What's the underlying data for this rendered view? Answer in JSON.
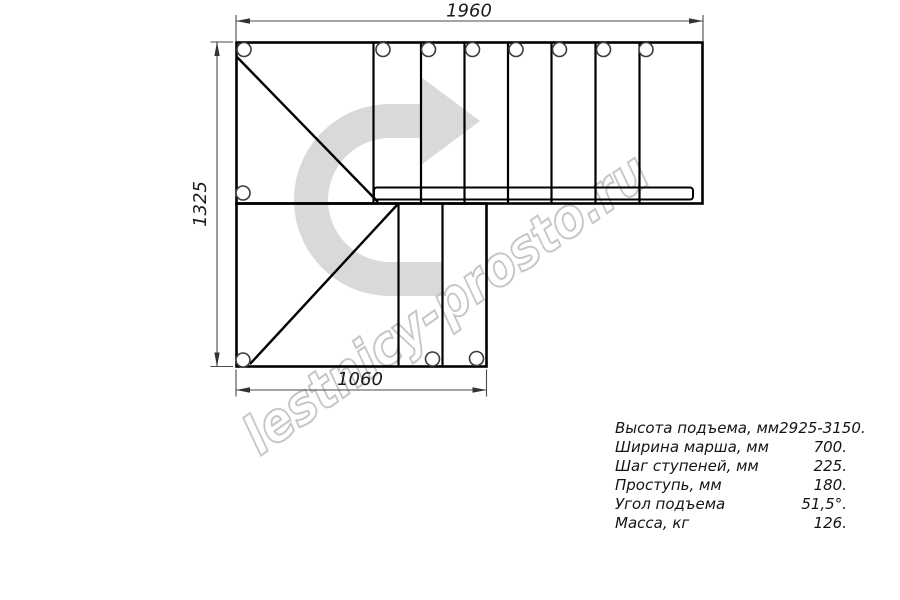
{
  "watermark": "lestnicy-prosto.ru",
  "dimensions": {
    "top": "1960",
    "left": "1325",
    "bottom": "1060"
  },
  "specs": {
    "rows": [
      {
        "label": "Высота подъема, мм",
        "value": "2925-3150."
      },
      {
        "label": "Ширина марша, мм",
        "value": "700."
      },
      {
        "label": "Шаг ступеней, мм",
        "value": "225."
      },
      {
        "label": "Проступь, мм",
        "value": "180."
      },
      {
        "label": "Угол подъема",
        "value": "51,5°."
      },
      {
        "label": "Масса, кг",
        "value": "126."
      }
    ]
  },
  "colors": {
    "background": "#ffffff",
    "drawing_line": "#000000",
    "dimension_line": "#4a4a4a",
    "direction_arrow": "#d9d9d9",
    "watermark_outline": "#c6c6c6",
    "text": "#141414"
  }
}
